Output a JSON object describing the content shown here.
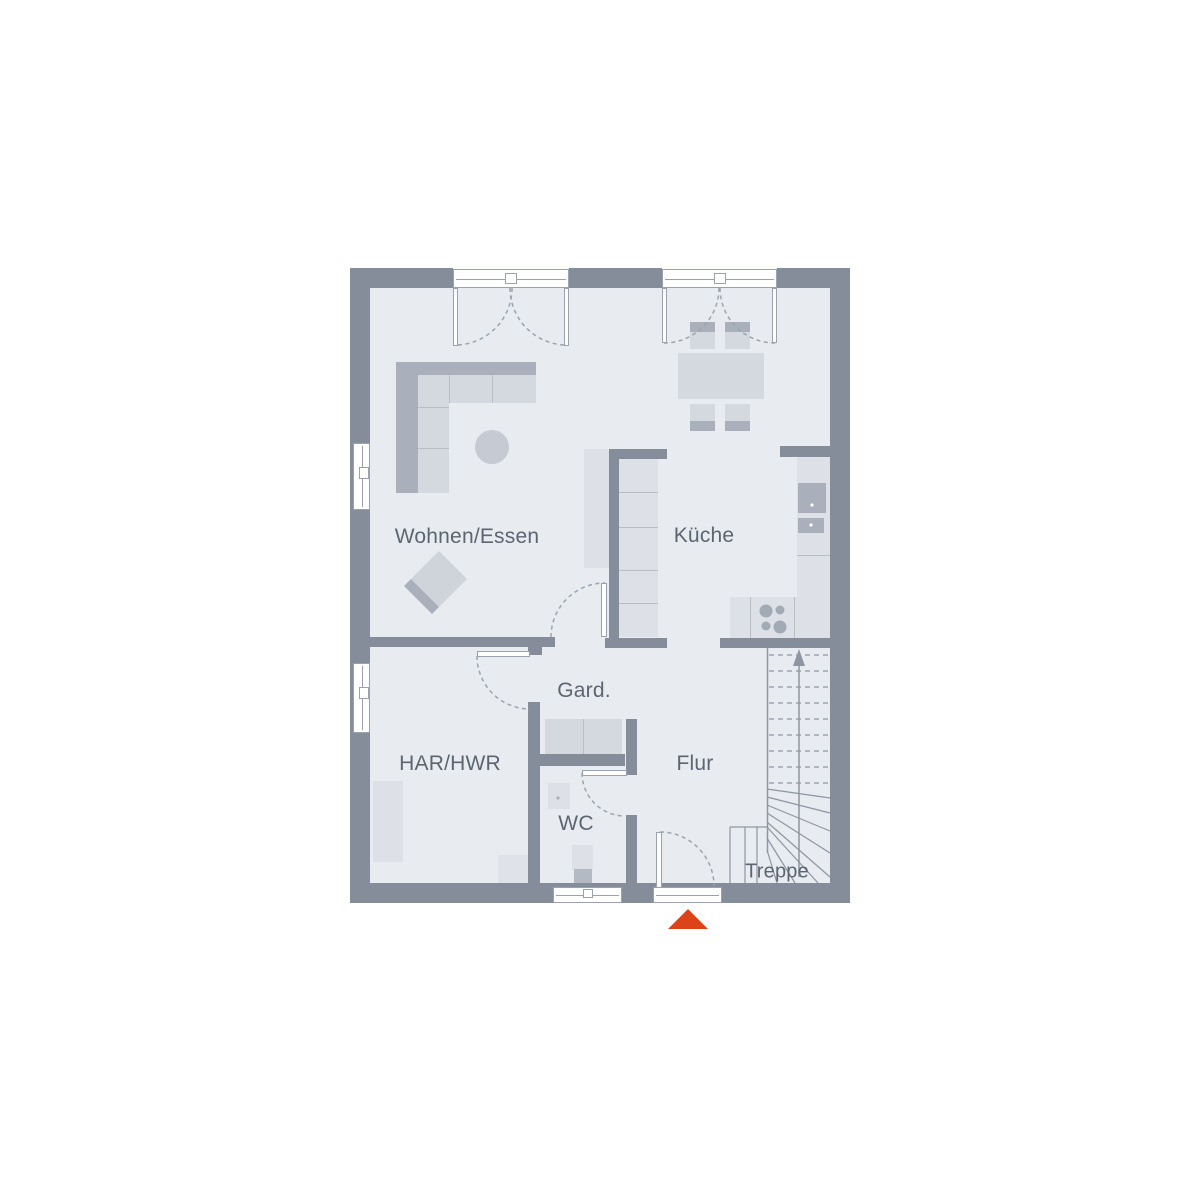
{
  "floorplan": {
    "labels": {
      "wohnen_essen": "Wohnen/Essen",
      "kueche": "Küche",
      "gard": "Gard.",
      "har_hwr": "HAR/HWR",
      "flur": "Flur",
      "wc": "WC",
      "treppe": "Treppe"
    },
    "colors": {
      "wall": "#848d99",
      "floor": "#e8ebf0",
      "furn": "#d4d8df",
      "furn_lt": "#dde0e6",
      "furn_dk": "#a9b0bb",
      "arc": "#9aa5b0",
      "stair": "#8d96a2",
      "text": "#5b6672",
      "accent": "#dc4318",
      "seam": "#b8bec7",
      "frame": "#9aa2ad"
    }
  }
}
